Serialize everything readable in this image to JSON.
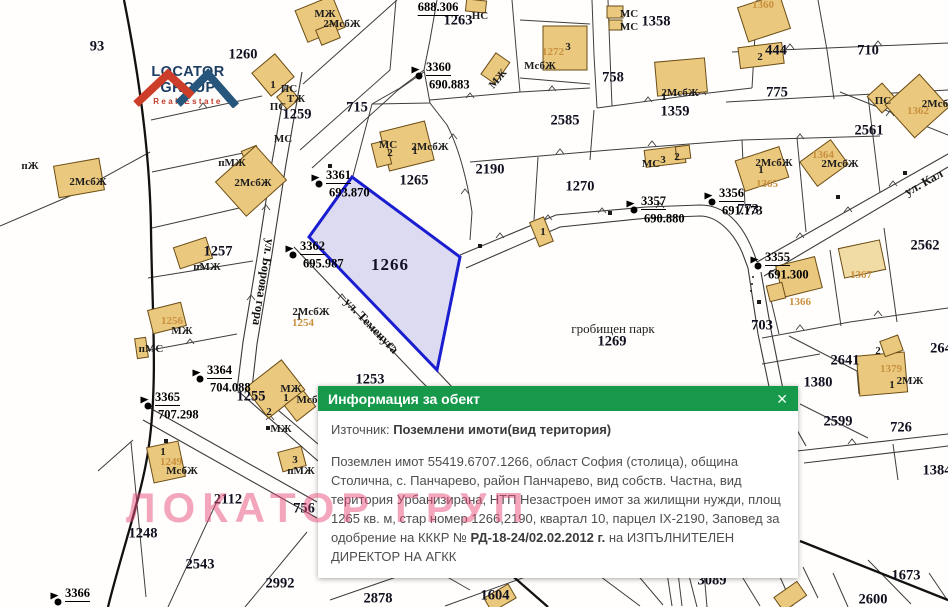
{
  "logo": {
    "name": "LOCATOR GROUP",
    "subtitle": "Real Estate"
  },
  "watermark": "ЛОКАТОР ГРУП",
  "popup": {
    "title": "Информация за обект",
    "close_icon": "✕",
    "source_label": "Източник: ",
    "source_value": "Поземлени имоти(вид територия)",
    "body_1": "Поземлен имот 55419.6707.1266, област София (столица), община Столична, с. Панчарево, район Панчарево, вид собств. Частна, вид територия Урбанизирана, НТП Незастроен имот за жилищни нужди, площ 1265 кв. м, стар номер 1266,2190, квартал 10, парцел IX-2190, Заповед за одобрение на КККР № ",
    "body_bold": "РД-18-24/02.02.2012 г.",
    "body_2": " на ИЗПЪЛНИТЕЛЕН ДИРЕКТОР НА АГКК"
  },
  "colors": {
    "popup_header": "#16994a",
    "selected_parcel_stroke": "#1b1ed0",
    "selected_parcel_fill": "#d7d5ee",
    "building_fill": "#eac87e",
    "watermark_pink": "#e74d7a",
    "logo_blue": "#1d3e63",
    "logo_red": "#c23b2a"
  },
  "map": {
    "selected_parcel": "1266",
    "labels": [
      {
        "t": "93",
        "x": 97,
        "y": 47,
        "c": "pnum"
      },
      {
        "t": "1260",
        "x": 243,
        "y": 55,
        "c": "pnum"
      },
      {
        "t": "1259",
        "x": 297,
        "y": 115,
        "c": "pnum"
      },
      {
        "t": "715",
        "x": 357,
        "y": 108,
        "c": "pnum"
      },
      {
        "t": "1263",
        "x": 458,
        "y": 21,
        "c": "pnum"
      },
      {
        "t": "1265",
        "x": 414,
        "y": 181,
        "c": "pnum"
      },
      {
        "t": "2190",
        "x": 490,
        "y": 170,
        "c": "pnum"
      },
      {
        "t": "1266",
        "x": 390,
        "y": 265,
        "c": "pnumL"
      },
      {
        "t": "1270",
        "x": 580,
        "y": 187,
        "c": "pnum"
      },
      {
        "t": "1358",
        "x": 656,
        "y": 22,
        "c": "pnum"
      },
      {
        "t": "2585",
        "x": 565,
        "y": 121,
        "c": "pnum"
      },
      {
        "t": "758",
        "x": 613,
        "y": 78,
        "c": "pnum"
      },
      {
        "t": "1359",
        "x": 675,
        "y": 112,
        "c": "pnum"
      },
      {
        "t": "710",
        "x": 868,
        "y": 51,
        "c": "pnum"
      },
      {
        "t": "444",
        "x": 776,
        "y": 51,
        "c": "pnum"
      },
      {
        "t": "775",
        "x": 777,
        "y": 93,
        "c": "pnum"
      },
      {
        "t": "2561",
        "x": 869,
        "y": 131,
        "c": "pnum"
      },
      {
        "t": "2562",
        "x": 925,
        "y": 246,
        "c": "pnum"
      },
      {
        "t": "773",
        "x": 748,
        "y": 210,
        "c": "pnum"
      },
      {
        "t": "703",
        "x": 762,
        "y": 326,
        "c": "pnum"
      },
      {
        "t": "2641",
        "x": 845,
        "y": 361,
        "c": "pnum"
      },
      {
        "t": "1380",
        "x": 818,
        "y": 383,
        "c": "pnum"
      },
      {
        "t": "2599",
        "x": 838,
        "y": 422,
        "c": "pnum"
      },
      {
        "t": "726",
        "x": 901,
        "y": 428,
        "c": "pnum"
      },
      {
        "t": "1384",
        "x": 937,
        "y": 471,
        "c": "pnum"
      },
      {
        "t": "264",
        "x": 941,
        "y": 349,
        "c": "pnum"
      },
      {
        "t": "1257",
        "x": 218,
        "y": 252,
        "c": "pnum"
      },
      {
        "t": "1255",
        "x": 251,
        "y": 397,
        "c": "pnum"
      },
      {
        "t": "1253",
        "x": 370,
        "y": 380,
        "c": "pnum"
      },
      {
        "t": "1248",
        "x": 143,
        "y": 534,
        "c": "pnum"
      },
      {
        "t": "2112",
        "x": 228,
        "y": 500,
        "c": "pnum"
      },
      {
        "t": "756",
        "x": 304,
        "y": 509,
        "c": "pnum"
      },
      {
        "t": "2543",
        "x": 200,
        "y": 565,
        "c": "pnum"
      },
      {
        "t": "2992",
        "x": 280,
        "y": 584,
        "c": "pnum"
      },
      {
        "t": "2878",
        "x": 378,
        "y": 599,
        "c": "pnum"
      },
      {
        "t": "1604",
        "x": 495,
        "y": 596,
        "c": "pnum"
      },
      {
        "t": "3089",
        "x": 712,
        "y": 581,
        "c": "pnum"
      },
      {
        "t": "2931",
        "x": 759,
        "y": 572,
        "c": "pnum",
        "r": -12
      },
      {
        "t": "1673",
        "x": 906,
        "y": 576,
        "c": "pnum"
      },
      {
        "t": "2600",
        "x": 873,
        "y": 600,
        "c": "pnum"
      },
      {
        "t": "1269",
        "x": 612,
        "y": 342,
        "c": "pnum"
      },
      {
        "t": "гробищен парк",
        "x": 613,
        "y": 329,
        "c": "area"
      },
      {
        "t": "688.306",
        "x": 438,
        "y": 8,
        "c": "survid"
      },
      {
        "t": "ул. Борова гора",
        "x": 263,
        "y": 282,
        "c": "street",
        "r": 99
      },
      {
        "t": "ул. Теменуга",
        "x": 371,
        "y": 326,
        "c": "street",
        "r": 46
      },
      {
        "t": "ул. Кал",
        "x": 924,
        "y": 183,
        "c": "street",
        "r": -29
      },
      {
        "t": "ПС",
        "x": 289,
        "y": 89,
        "c": "bcode"
      },
      {
        "t": "ТЖ",
        "x": 296,
        "y": 99,
        "c": "bcode"
      },
      {
        "t": "ПС",
        "x": 278,
        "y": 107,
        "c": "bcode"
      },
      {
        "t": "МС",
        "x": 283,
        "y": 139,
        "c": "bcode"
      },
      {
        "t": "МЖ",
        "x": 325,
        "y": 14,
        "c": "bcode"
      },
      {
        "t": "2МсбЖ",
        "x": 342,
        "y": 24,
        "c": "bcode"
      },
      {
        "t": "пМЖ",
        "x": 232,
        "y": 163,
        "c": "bcode"
      },
      {
        "t": "2МсбЖ",
        "x": 253,
        "y": 183,
        "c": "bcode"
      },
      {
        "t": "2МсбЖ",
        "x": 88,
        "y": 182,
        "c": "bcode"
      },
      {
        "t": "пЖ",
        "x": 30,
        "y": 166,
        "c": "bcode"
      },
      {
        "t": "пМЖ",
        "x": 207,
        "y": 267,
        "c": "bcode"
      },
      {
        "t": "МЖ",
        "x": 182,
        "y": 331,
        "c": "bcode"
      },
      {
        "t": "пМС",
        "x": 151,
        "y": 349,
        "c": "bcode"
      },
      {
        "t": "НС",
        "x": 480,
        "y": 16,
        "c": "bcode"
      },
      {
        "t": "МЖ",
        "x": 498,
        "y": 79,
        "c": "bcode",
        "r": -50
      },
      {
        "t": "МС",
        "x": 629,
        "y": 14,
        "c": "bcode"
      },
      {
        "t": "МС",
        "x": 629,
        "y": 27,
        "c": "bcode"
      },
      {
        "t": "МсбЖ",
        "x": 540,
        "y": 66,
        "c": "bcode"
      },
      {
        "t": "1",
        "x": 664,
        "y": 97,
        "c": "bcode"
      },
      {
        "t": "2МсбЖ",
        "x": 680,
        "y": 93,
        "c": "bcode"
      },
      {
        "t": "МС",
        "x": 651,
        "y": 164,
        "c": "bcode"
      },
      {
        "t": "3",
        "x": 663,
        "y": 160,
        "c": "bcode"
      },
      {
        "t": "2",
        "x": 677,
        "y": 157,
        "c": "bcode"
      },
      {
        "t": "МС",
        "x": 388,
        "y": 145,
        "c": "bcode"
      },
      {
        "t": "2",
        "x": 390,
        "y": 153,
        "c": "bcode"
      },
      {
        "t": "1",
        "x": 415,
        "y": 151,
        "c": "bcode"
      },
      {
        "t": "2МсбЖ",
        "x": 430,
        "y": 147,
        "c": "bcode"
      },
      {
        "t": "1",
        "x": 761,
        "y": 170,
        "c": "bcode"
      },
      {
        "t": "2МсбЖ",
        "x": 774,
        "y": 163,
        "c": "bcode"
      },
      {
        "t": "2МсбЖ",
        "x": 840,
        "y": 164,
        "c": "bcode"
      },
      {
        "t": "2Мсб",
        "x": 935,
        "y": 104,
        "c": "bcode"
      },
      {
        "t": "ПС",
        "x": 883,
        "y": 101,
        "c": "bcode"
      },
      {
        "t": "1",
        "x": 299,
        "y": 317,
        "c": "bcode"
      },
      {
        "t": "2МсбЖ",
        "x": 311,
        "y": 312,
        "c": "bcode"
      },
      {
        "t": "МЖ",
        "x": 291,
        "y": 389,
        "c": "bcode"
      },
      {
        "t": "1",
        "x": 286,
        "y": 398,
        "c": "bcode"
      },
      {
        "t": "2",
        "x": 269,
        "y": 412,
        "c": "bcode"
      },
      {
        "t": "МЖ",
        "x": 281,
        "y": 429,
        "c": "bcode"
      },
      {
        "t": "Мсб",
        "x": 307,
        "y": 400,
        "c": "bcode"
      },
      {
        "t": "3",
        "x": 295,
        "y": 460,
        "c": "bcode"
      },
      {
        "t": "пМЖ",
        "x": 301,
        "y": 471,
        "c": "bcode"
      },
      {
        "t": "1",
        "x": 163,
        "y": 452,
        "c": "bcode"
      },
      {
        "t": "МсбЖ",
        "x": 182,
        "y": 471,
        "c": "bcode"
      },
      {
        "t": "2МЖ",
        "x": 910,
        "y": 381,
        "c": "bcode"
      },
      {
        "t": "1",
        "x": 892,
        "y": 385,
        "c": "bcode"
      },
      {
        "t": "2",
        "x": 878,
        "y": 351,
        "c": "bcode"
      },
      {
        "t": "1",
        "x": 543,
        "y": 232,
        "c": "bcode"
      },
      {
        "t": "2",
        "x": 760,
        "y": 57,
        "c": "bcode"
      },
      {
        "t": "1",
        "x": 273,
        "y": 85,
        "c": "bcode"
      },
      {
        "t": "3",
        "x": 568,
        "y": 47,
        "c": "bcode"
      },
      {
        "t": "1272",
        "x": 553,
        "y": 52,
        "c": "bnum"
      },
      {
        "t": "1360",
        "x": 763,
        "y": 5,
        "c": "bnum"
      },
      {
        "t": "1365",
        "x": 767,
        "y": 184,
        "c": "bnum"
      },
      {
        "t": "1364",
        "x": 823,
        "y": 155,
        "c": "bnum"
      },
      {
        "t": "1362",
        "x": 918,
        "y": 111,
        "c": "bnum"
      },
      {
        "t": "1366",
        "x": 800,
        "y": 302,
        "c": "bnum"
      },
      {
        "t": "1367",
        "x": 861,
        "y": 275,
        "c": "bnum"
      },
      {
        "t": "1254",
        "x": 303,
        "y": 323,
        "c": "bnum"
      },
      {
        "t": "1256",
        "x": 172,
        "y": 321,
        "c": "bnum"
      },
      {
        "t": "1249",
        "x": 171,
        "y": 462,
        "c": "bnum"
      },
      {
        "t": "1379",
        "x": 891,
        "y": 369,
        "c": "bnum"
      }
    ],
    "survey_points": [
      {
        "id": "3360",
        "elev": "690.883",
        "x": 419,
        "y": 76
      },
      {
        "id": "3361",
        "elev": "693.870",
        "x": 319,
        "y": 184
      },
      {
        "id": "3362",
        "elev": "695.987",
        "x": 293,
        "y": 255
      },
      {
        "id": "3357",
        "elev": "690.880",
        "x": 634,
        "y": 210
      },
      {
        "id": "3356",
        "elev": "691.173",
        "x": 712,
        "y": 202
      },
      {
        "id": "3355",
        "elev": "691.300",
        "x": 758,
        "y": 266
      },
      {
        "id": "3364",
        "elev": "704.088",
        "x": 200,
        "y": 379
      },
      {
        "id": "3365",
        "elev": "707.298",
        "x": 148,
        "y": 406
      },
      {
        "id": "3366",
        "elev": "",
        "x": 58,
        "y": 602
      }
    ]
  }
}
